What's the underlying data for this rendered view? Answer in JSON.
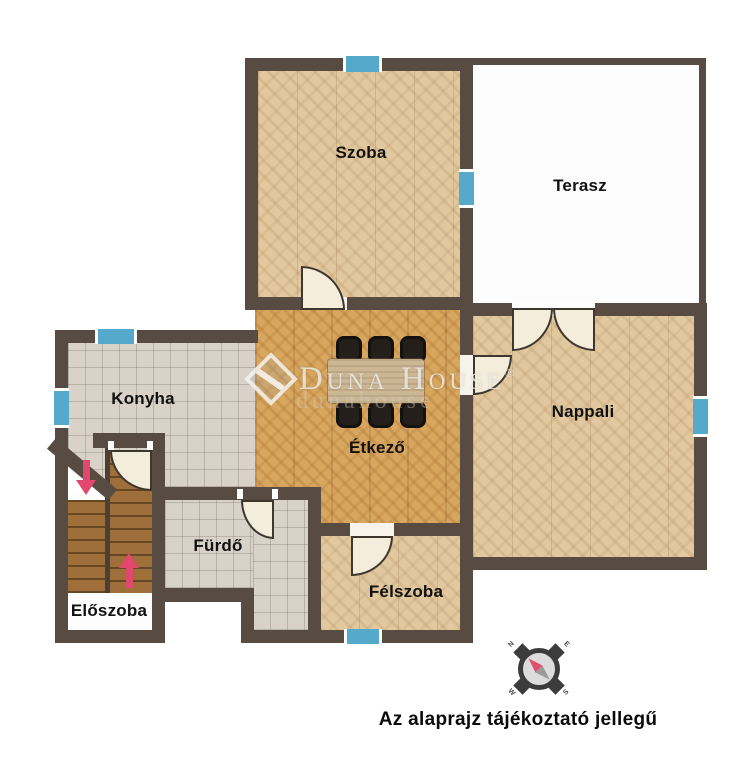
{
  "caption": {
    "text": "Az alaprajz tájékoztató jellegű"
  },
  "rooms": [
    {
      "id": "szoba",
      "label": "Szoba"
    },
    {
      "id": "terasz",
      "label": "Terasz"
    },
    {
      "id": "konyha",
      "label": "Konyha"
    },
    {
      "id": "etkezo",
      "label": "Étkező"
    },
    {
      "id": "nappali",
      "label": "Nappali"
    },
    {
      "id": "furdo",
      "label": "Fürdő"
    },
    {
      "id": "felszoba",
      "label": "Félszoba"
    },
    {
      "id": "eloszoba",
      "label": "Előszoba"
    }
  ],
  "watermark": {
    "brand": "Duna House",
    "registered": "®",
    "echo": "dunahouse"
  },
  "compass": {
    "n": "N",
    "e": "E",
    "s": "S",
    "w": "W"
  },
  "icons": {
    "stairs_up": "arrow-up",
    "stairs_down": "arrow-down",
    "compass": "compass-rose"
  },
  "colors": {
    "wall": "#584c42",
    "window_blue": "#55a9cb",
    "door_cream": "#f4eddb",
    "floor_wood_light": "#e1c89f",
    "floor_wood_dining": "#d8a75f",
    "floor_tile": "#d8d2c9",
    "stairs_wood": "#9e6f3a",
    "arrow_pink": "#e2476d",
    "compass_needle_red": "#e0506e",
    "compass_needle_grey": "#9a9a9a",
    "label_black": "#111111"
  }
}
